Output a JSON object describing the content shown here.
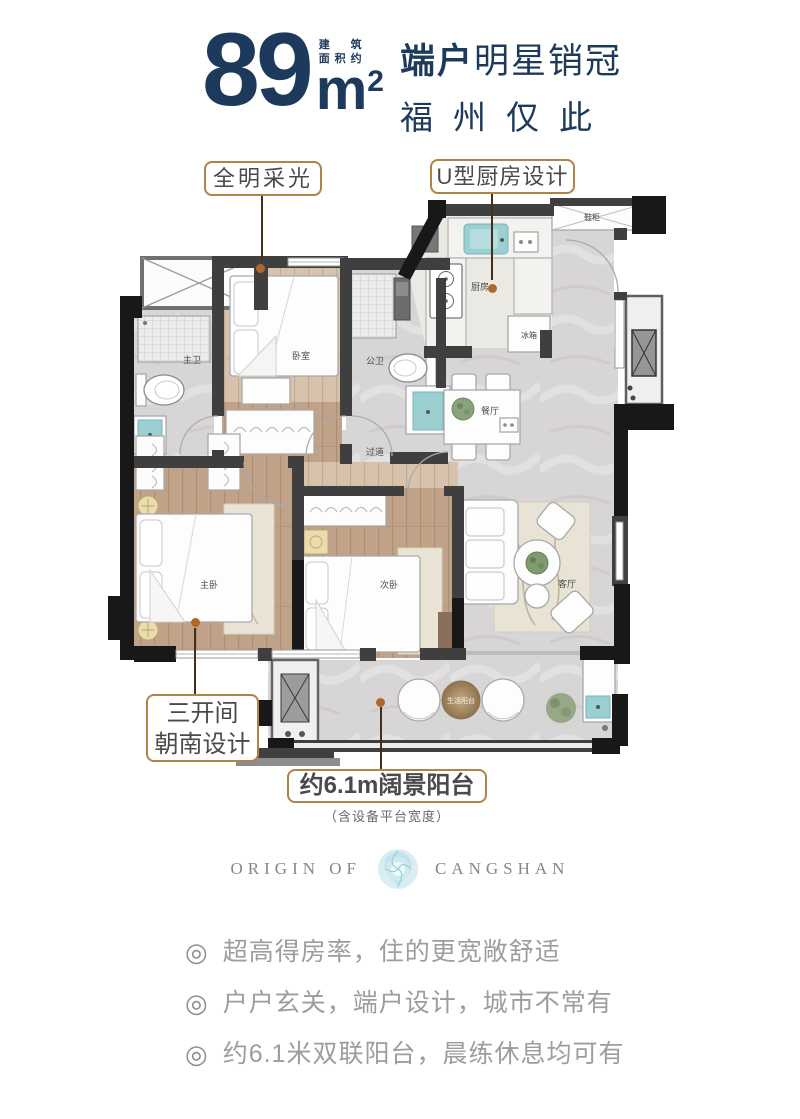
{
  "header": {
    "area_value": "89",
    "area_unit_base": "m",
    "area_unit_sup": "2",
    "area_label_line1": "建筑",
    "area_label_line2": "面积约",
    "title_bold": "端户",
    "title_rest": "明星销冠",
    "subtitle": "福州仅此"
  },
  "callouts": {
    "daylight": "全明采光",
    "ukitchen": "U型厨房设计",
    "south_line1": "三开间",
    "south_line2": "朝南设计",
    "balcony": "约6.1m阔景阳台",
    "balcony_note": "（含设备平台宽度）"
  },
  "floorplan": {
    "rooms": {
      "master_bath": "主卫",
      "bedroom": "卧室",
      "public_bath": "公卫",
      "kitchen": "厨房",
      "fridge": "冰箱",
      "shoe_cabinet": "鞋柜",
      "dining": "餐厅",
      "hallway": "过道",
      "master_bedroom": "主卧",
      "second_bedroom": "次卧",
      "living_room": "客厅",
      "life_balcony": "生活阳台"
    }
  },
  "logo": {
    "left": "ORIGIN OF",
    "right": "CANGSHAN"
  },
  "features": {
    "bullet_icon": "◎",
    "items": [
      "超高得房率，住的更宽敞舒适",
      "户户玄关，端户设计，城市不常有",
      "约6.1米双联阳台，晨练休息均可有"
    ]
  },
  "colors": {
    "navy": "#1d3a5c",
    "callout_border": "#b08347",
    "leader_dot": "#b2672a",
    "fixture_teal": "#9ccfd2",
    "flower_blue": "#c3e2ec",
    "text_gray": "#9d9d9d"
  }
}
